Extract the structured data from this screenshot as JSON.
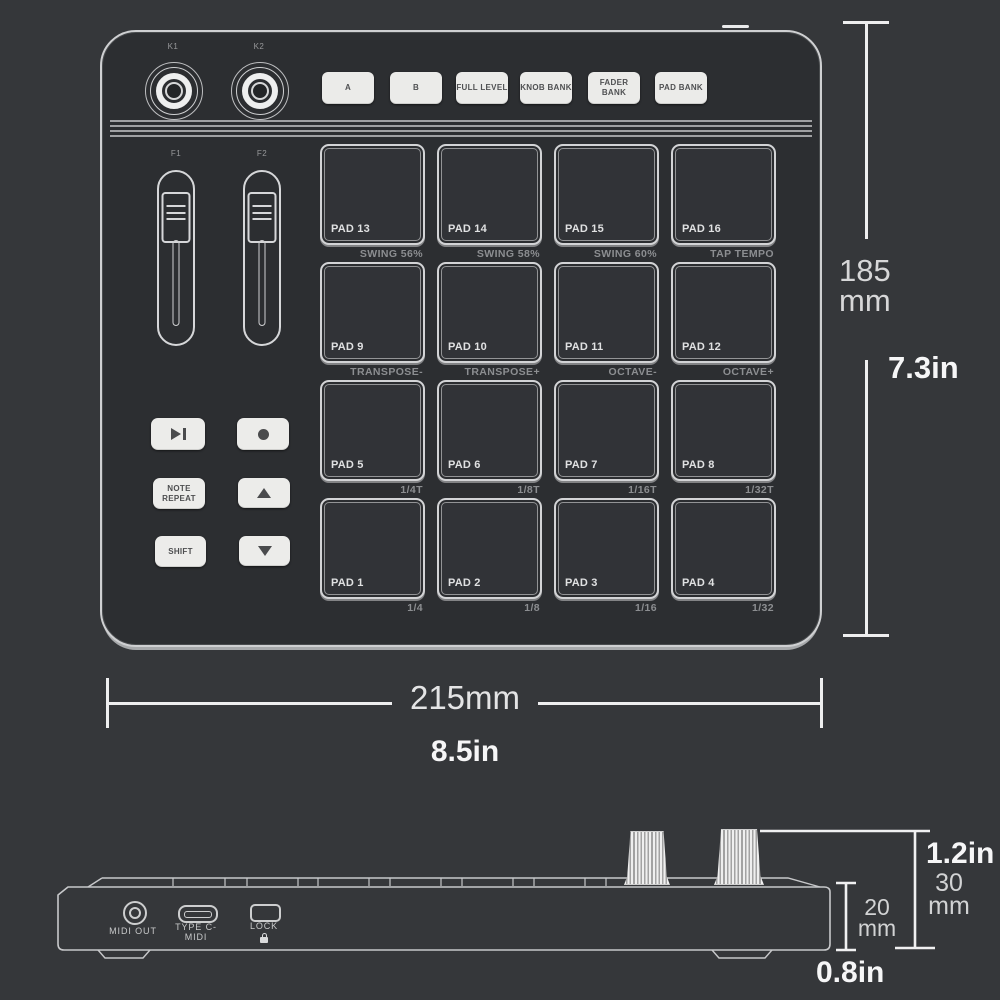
{
  "colors": {
    "background": "#35373a",
    "device_fill": "#2c2e31",
    "outline": "#cfd0d2",
    "pad_fill": "#313337",
    "button_fill": "#ebebe9",
    "button_text": "#4f5052",
    "sub_label": "#8c8e91",
    "dimension_line": "#eeeeef",
    "dimension_text": "#d7d7d8",
    "dimension_text_bold": "#f6f6f7"
  },
  "top_view": {
    "knobs": [
      {
        "label": "K1"
      },
      {
        "label": "K2"
      }
    ],
    "buttons": [
      {
        "label": "A"
      },
      {
        "label": "B"
      },
      {
        "label": "FULL LEVEL"
      },
      {
        "label": "KNOB BANK"
      },
      {
        "label": "FADER BANK"
      },
      {
        "label": "PAD BANK"
      }
    ],
    "faders": [
      {
        "label": "F1"
      },
      {
        "label": "F2"
      }
    ],
    "transport": {
      "play_icon": "play-pause",
      "record_icon": "record",
      "note_repeat_label": "NOTE REPEAT",
      "up_icon": "up-arrow",
      "shift_label": "SHIFT",
      "down_icon": "down-arrow"
    },
    "pad_rows": [
      {
        "pads": [
          {
            "name": "PAD 13",
            "sub": "SWING 56%"
          },
          {
            "name": "PAD 14",
            "sub": "SWING 58%"
          },
          {
            "name": "PAD 15",
            "sub": "SWING 60%"
          },
          {
            "name": "PAD 16",
            "sub": "TAP TEMPO"
          }
        ]
      },
      {
        "pads": [
          {
            "name": "PAD 9",
            "sub": "TRANSPOSE-"
          },
          {
            "name": "PAD 10",
            "sub": "TRANSPOSE+"
          },
          {
            "name": "PAD 11",
            "sub": "OCTAVE-"
          },
          {
            "name": "PAD 12",
            "sub": "OCTAVE+"
          }
        ]
      },
      {
        "pads": [
          {
            "name": "PAD 5",
            "sub": "1/4T"
          },
          {
            "name": "PAD 6",
            "sub": "1/8T"
          },
          {
            "name": "PAD 7",
            "sub": "1/16T"
          },
          {
            "name": "PAD 8",
            "sub": "1/32T"
          }
        ]
      },
      {
        "pads": [
          {
            "name": "PAD 1",
            "sub": "1/4"
          },
          {
            "name": "PAD 2",
            "sub": "1/8"
          },
          {
            "name": "PAD 3",
            "sub": "1/16"
          },
          {
            "name": "PAD 4",
            "sub": "1/32"
          }
        ]
      }
    ]
  },
  "dimensions": {
    "height_mm": "185",
    "height_mm_unit": "mm",
    "height_in": "7.3in",
    "width_mm": "215mm",
    "width_in": "8.5in",
    "knob_height_in": "1.2in",
    "knob_height_mm": "30",
    "knob_height_mm_unit": "mm",
    "body_height_mm": "20",
    "body_height_mm_unit": "mm",
    "body_height_in": "0.8in"
  },
  "side_view": {
    "ports": {
      "midi_out": "MIDI OUT",
      "usb": "TYPE C-MIDI",
      "lock": "LOCK"
    }
  }
}
